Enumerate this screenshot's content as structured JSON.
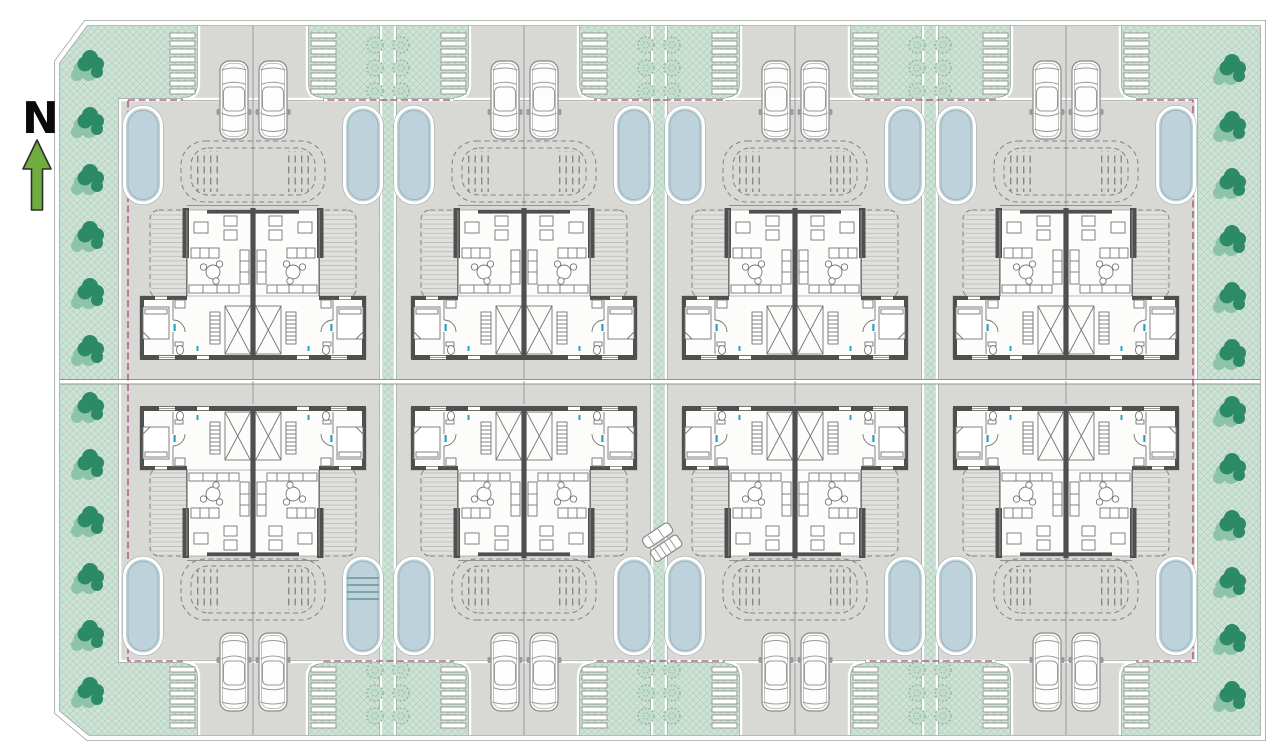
{
  "north": {
    "label": "N"
  },
  "site": {
    "column_blocks": 4,
    "duplex_buildings": 8,
    "dwelling_units": 16,
    "pools": 16,
    "pools_with_steps": 1,
    "parked_cars_top": 8,
    "parked_cars_bottom": 8,
    "diagonal_parked_vehicles": 2,
    "parking_stripe_stacks": 16,
    "stripes_per_stack": 8,
    "border_bushes_left": 12,
    "border_bushes_right": 12,
    "pergola_gardens": 8,
    "tree_strips_between_blocks": 3,
    "trees_per_strip": 12
  },
  "colors": {
    "page-bg": "#ffffff",
    "green-base": "#cfe2d6",
    "green-hatch": "#9cc3ae",
    "bush-dark": "#2c8a67",
    "bush-light": "#8cc3a9",
    "tree-light": "#c4dccb",
    "paving": "#d8d9d5",
    "line-gray": "#8f948f",
    "pool-water": "#bdd2da",
    "property-line": "#a04a78",
    "wall-dark": "#4f4f4f",
    "furniture-line": "#757575",
    "north-arrow": "#6fae3e",
    "fixture-accent": "#2f9fc0"
  },
  "icons": [
    "north-arrow-icon",
    "car-icon",
    "pool-icon",
    "tree-icon",
    "bush-icon",
    "parking-stripes-icon",
    "pergola-garden-icon",
    "stairs-icon",
    "bed-icon",
    "sofa-icon",
    "dining-table-icon",
    "toilet-icon",
    "kitchen-counter-icon"
  ]
}
